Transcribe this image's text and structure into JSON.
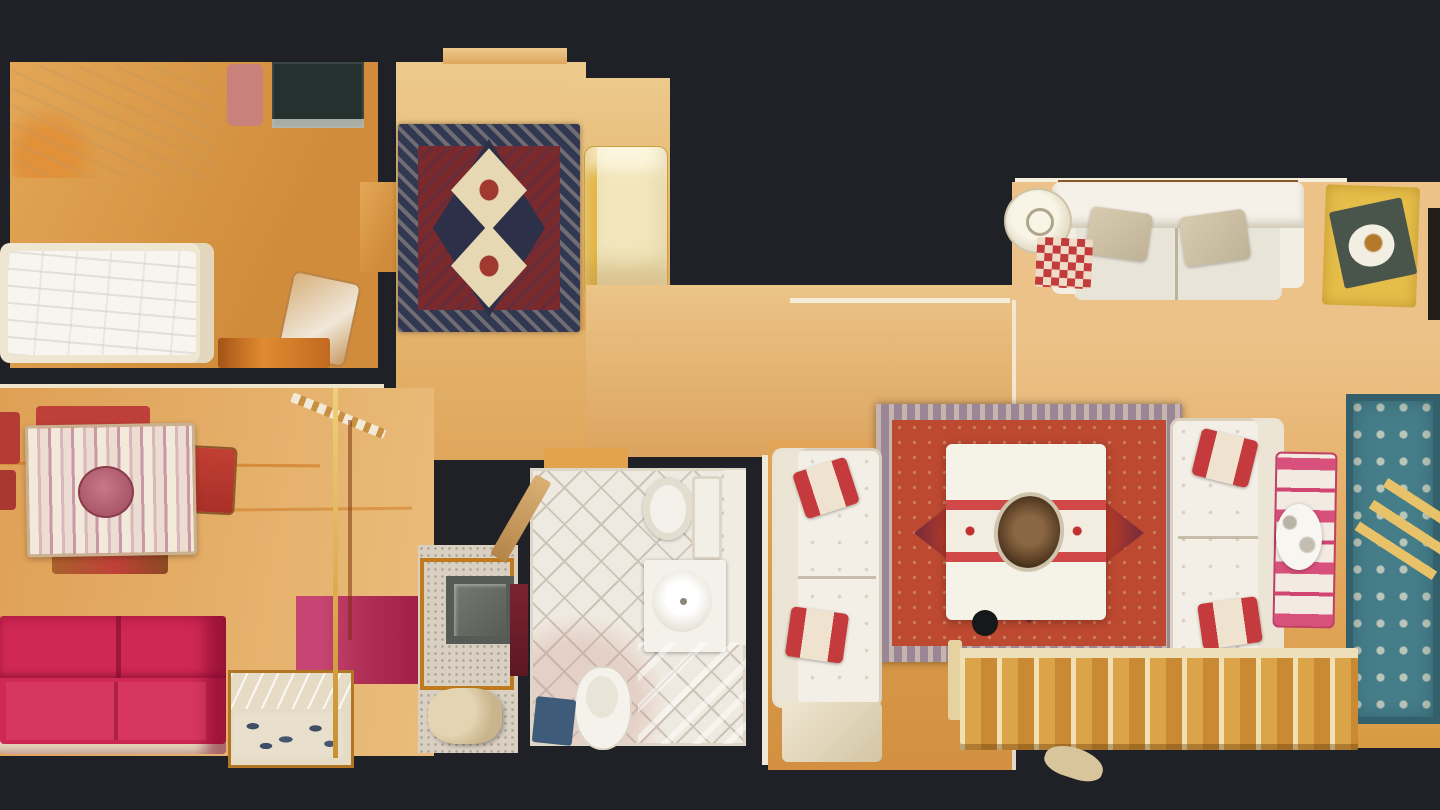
{
  "app": {
    "name": "3d-apartment-scan",
    "view": "top-down-floorplan"
  },
  "palette": {
    "background": "#1f2126",
    "wood_base": "#dda256",
    "wood_light": "#e9c07c",
    "wood_dark": "#d08c3a",
    "rug_hall_border": "#323752",
    "rug_hall_field": "#7a2a2c",
    "rug_hall_medallion": "#e6d8b2",
    "rug_red_border": "#9a8694",
    "rug_red_field": "#bc4930",
    "rug_blue": "#457d89",
    "sofa_white": "#f3efe6",
    "cushion_tan": "#d2c5a9",
    "sofa_red": "#ce2853",
    "pillow_red": "#c53a3c",
    "tablecloth": "#f0e8da",
    "tile": "#efeae1",
    "tile_line": "#cdc3b6",
    "stair_tread": "#dca448",
    "terrazzo": "#d9d0c2",
    "magenta_rug": "#b03058",
    "ottoman_yellow": "#e5be4a",
    "marble": "#d4d9dd",
    "glass_line": "#f2ead8"
  },
  "scene": {
    "rooms": [
      {
        "name": "bedroom",
        "position": "top-left",
        "items": [
          "double-bed",
          "single-bed",
          "media-desk",
          "pink-pillow",
          "desk-chair",
          "wood-bench"
        ]
      },
      {
        "name": "hallway",
        "position": "top-center",
        "items": [
          "oriental-rug-two-medallions",
          "cream-lounge-chair"
        ]
      },
      {
        "name": "dining-room",
        "position": "bottom-left",
        "items": [
          "dining-table-striped-cloth",
          "centerpiece",
          "red-chairs",
          "red-sofa",
          "sideboard-marble-top",
          "magenta-rug",
          "ladder",
          "floor-lamp-pole"
        ]
      },
      {
        "name": "kitchen-nook",
        "position": "bottom-center-left",
        "items": [
          "terrazzo-floor",
          "counter-frame",
          "sink-box"
        ]
      },
      {
        "name": "bathroom",
        "position": "bottom-center",
        "items": [
          "toilet",
          "wash-basin",
          "bidet",
          "blue-bath-mat",
          "shower-cabinet",
          "door-leaf"
        ]
      },
      {
        "name": "living-room",
        "position": "right",
        "items": [
          "white-sofa-top",
          "white-sofa-left",
          "white-sofa-right",
          "red-oriental-rug",
          "coffee-table-runner-bowl",
          "blue-oriental-rug",
          "reindeer-daybed",
          "white-dog",
          "staircase",
          "yellow-ottoman-tray",
          "round-side-table",
          "checkered-cushion",
          "glass-partition",
          "dark-cabinet"
        ]
      }
    ]
  }
}
